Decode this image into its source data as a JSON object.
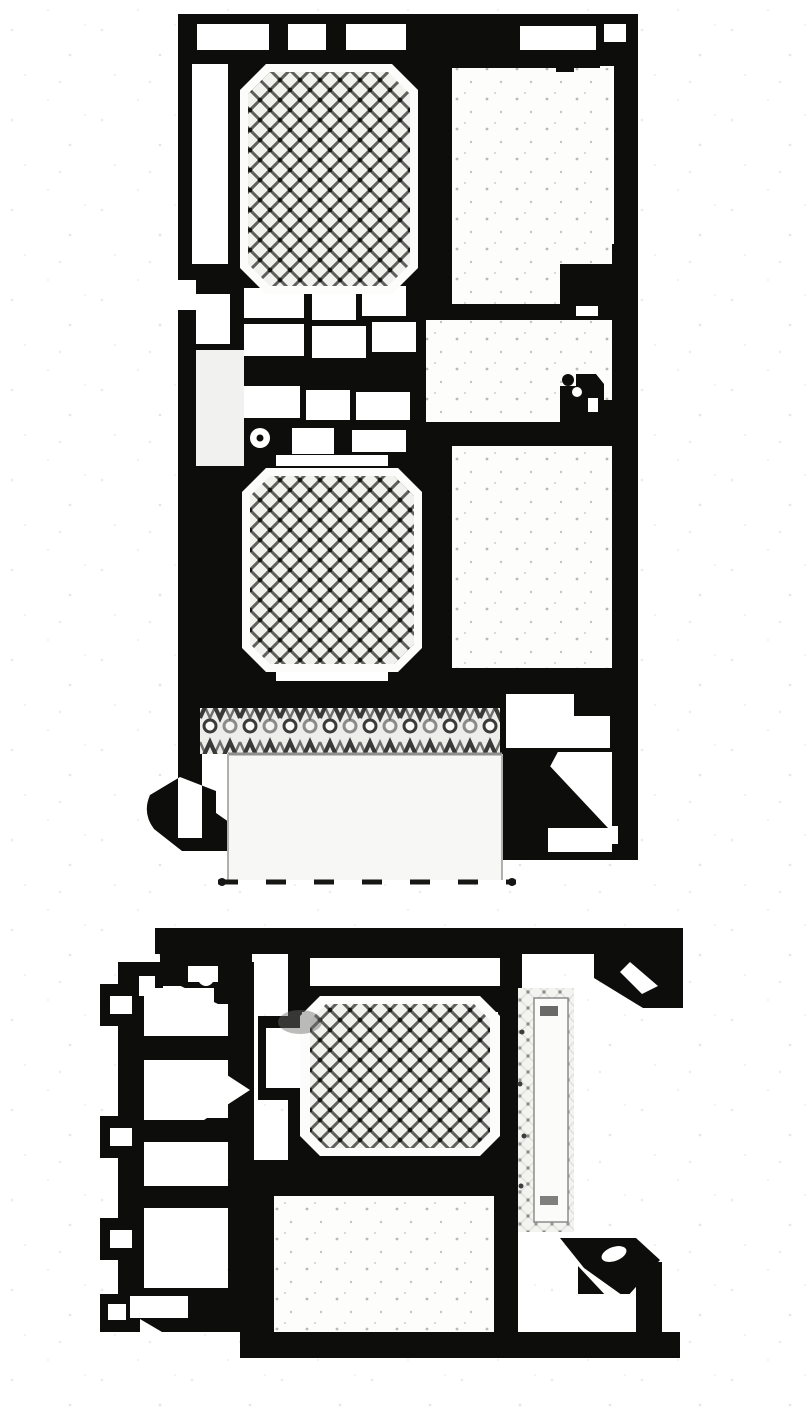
{
  "canvas": {
    "width": 810,
    "height": 1413,
    "background": "#ffffff"
  },
  "colors": {
    "ink": "#0d0d0b",
    "paper": "#ffffff",
    "hatch_line": "#5f5f5c",
    "hatch_bg": "#f1f1ee",
    "seal_line": "#3a3a38",
    "glass_fill": "#f7f7f5",
    "glass_outline": "#8f8f8d",
    "texture_bg": "#f3f3f0",
    "speckle": "#b9b9b6",
    "soft_gray": "#6a6a68"
  },
  "figures": [
    {
      "id": "section-top",
      "name": "profile-cross-section-vertical-meeting-rail",
      "components": [
        "screw-channel-rail",
        "outer-frame-wall",
        "thermal-insulation-block-upper",
        "interlock-chamber-cluster",
        "hollow-chamber-large",
        "lock-keep-detail",
        "thermal-insulation-block-lower",
        "brush-seal-band",
        "glass-panel",
        "glazing-clamp-corner"
      ]
    },
    {
      "id": "section-bottom",
      "name": "profile-cross-section-horizontal-jamb",
      "components": [
        "head-rail-with-corner-cleats",
        "guide-rail-multi-chamber-strip",
        "gasket-link-cluster",
        "thermal-insulation-block-center",
        "insulation-foam-strip",
        "hollow-chamber-large",
        "glazing-clamp-corner",
        "base-rail"
      ]
    }
  ]
}
